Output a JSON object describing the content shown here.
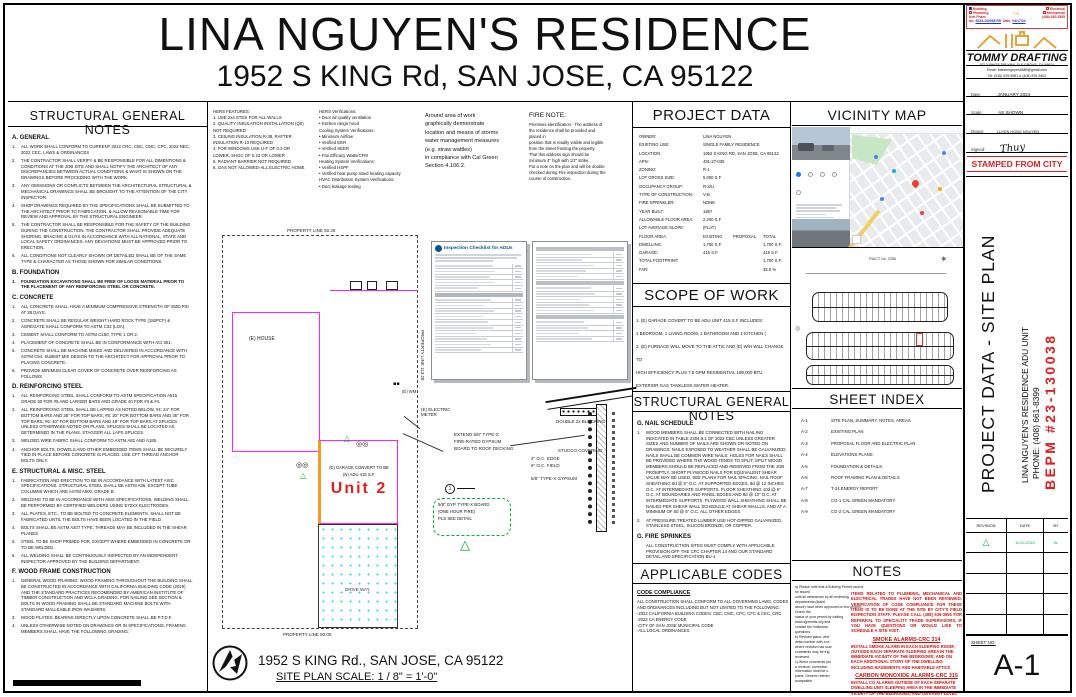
{
  "page": {
    "title": "LINA NGUYEN'S RESIDENCE",
    "subtitle": "1952 S KING Rd, SAN JOSE, CA 95122"
  },
  "structural_notes_left": {
    "title": "STRUCTURAL GENERAL NOTES",
    "sections": [
      {
        "heading": "A. GENERAL",
        "items": [
          {
            "num": "1.",
            "text": "ALL WORK SHALL CONFORM TO CURRENT 2022 CRC, CBC, CMC, CPC, 2022 NEC, 2022 CEC, LAWS & ORDINANCES"
          },
          {
            "num": "2.",
            "text": "THE CONTRACTOR SHALL VERIFY & BE RESPONSIBLE FOR ALL DIMENTIONS & CONDITIONS AT THE JOB SITE AND SHALL NOTIFY THE ARCHITECT OF ANY DISCREPANCIES BETWEEN ACTUAL CONDITIONS & WHAT IS SHOWN ON THE DRAWINGS BEFORE PROCEDING WITH THE WORK."
          },
          {
            "num": "3.",
            "text": "ANY OMISSIONS OR CONFLICTS BETWEEN THE ARCHITECTURAL STRUCTURAL & MECHANICAL DRAWINGS SHALL BE BROUGHT TO THE ATTENTION OF THE CITY INSPECTOR."
          },
          {
            "num": "4.",
            "text": "SHOP DRAWINGS REQUIRED BY THE SPECIFICATIONS SHALL BE SUBMITTED TO THE ARCHITECT PRIOR TO FABRICATION, & ALLOW REASONABLE TIME FOR REVIEW AND APPROVAL BY THE STRUCTURAL ENGINEER."
          },
          {
            "num": "5.",
            "text": "THE CONTRACTOR SHALL BE RESPONSIBLE FOR THE SAFETY OF THE BUILDING DURING THE CONSTRUCTION. THE CONTRACTOR SHALL PROVIDE ADEQUATE SHORING, BRACING & GUYS IN ACCORDANCE WITH ALL NATIONAL, STATE AND LOCAL SAFETY ORDINANCES. ANY DEVIATIONS MUST BE APPROVED PRIOR TO ERECTION."
          },
          {
            "num": "6.",
            "text": "ALL CONDITIONS NOT CLEARLY SHOWN OR DETAILED SHALL BE OF THE SAME TYPE & CHARACTER AS THOSE SHOWN FOR SIMILAR CONDITIONS."
          }
        ]
      },
      {
        "heading": "B. FOUNDATION",
        "items": [
          {
            "num": "1.",
            "text": "FOUNDATION EXCAVATIONS SHALL BE FREE OF LOOSE MATERIAL PRIOR TO THE PLACEMENT OF ANY REINFORCING STEEL OR CONCRETE.",
            "bold": true
          }
        ]
      },
      {
        "heading": "C. CONCRETE",
        "items": [
          {
            "num": "1.",
            "text": "ALL CONCRETE SHALL HAVE A MINIMUM COMPRESSIVE STRENGTH OF 2500 PSI AT 28 DAYS."
          },
          {
            "num": "2.",
            "text": "CONCRETE SHALL BE REGULAR WEIGHT HARD ROCK TYPE (150PCF) & AGREGATE SHALL CONFORM TO ASTM C33 (LOA)."
          },
          {
            "num": "3.",
            "text": "CEMENT SHALL CONFORM TO ASTM C150, TYPE 1 OR 2."
          },
          {
            "num": "4.",
            "text": "PLACEMENT OF CONCRETE SHALL BE IN CONFORMANCE WITH ACI 301."
          },
          {
            "num": "5.",
            "text": "CONCRETE SHALL BE MACHINE MIXED AND DELIVERED IN ACCORDANCE WITH ASTM C94. SUBMIT MIX DESIGN TO THE ARCHITECT FOR APPROVAL PRIOR TO PLACING CONCRETE."
          },
          {
            "num": "6.",
            "text": "PROVIDE MINIMUM CLEAR COVER OF CONCRETE OVER REINFORCING AS FOLLOWS"
          }
        ]
      },
      {
        "heading": "D. REINFORCING STEEL",
        "items": [
          {
            "num": "1.",
            "text": "ALL REINFORCING STEEL SHALL CONFORM TO ASTM SPECIFICATION A615 GRADE 60 FOR #5 AND LARGER BARS AND GRADE 40 FOR #3 & #4."
          },
          {
            "num": "2.",
            "text": "ALL REINFORCING STEEL SHALL BE LAPPED AS NOTED BELOW, #4: 24\" FOR BOTTOM BARS AND 35\" FOR TOP BARS; #5: 30\" FOR BOTTOM BARS AND 35\" FOR TOP BARS; #6: 40\" FOR BOTTOM BARS AND 48\" FOR TOP BARS AT SPLICES UNLESS OTHERWISE NOTED ON PLANS. SPLICES SHALL BE LOCATED AS DETERMINED IN THE PLANS. STAGGER ALL LAPS SPLICES."
          },
          {
            "num": "3.",
            "text": "WELDED WIRE FABRIC SHALL CONFORM TO ASTM A82 AND A185."
          },
          {
            "num": "4.",
            "text": "ANCHOR BOLTS, DOWELS AND OTHER EMBEDDED ITEMS SHALL BE SECURELY TIED IN PLACE BEFORE CONCRETE IS PLACED. USE CFT THREAD ANCHOR BOLTS ONLY."
          }
        ]
      },
      {
        "heading": "E. STRUCTURAL & MISC. STEEL",
        "items": [
          {
            "num": "1.",
            "text": "FABRICATION AND ERECTION TO BE IN ACCORDANCE WITH LATEST AISC SPECIFICATIONS. STRUCTURAL STEEL SHALL BE ASTM A36, EXCEPT TUBE COLUMNS WHICH ARE ASTM A500, GRADE B."
          },
          {
            "num": "2.",
            "text": "WELDING TO BE IN ACCORDANCE WITH AWS SPECIFICATIONS. WELDING SHALL BE PERFORMED BY CERTIFIED WELDERS USING E70XX ELECTRODES."
          },
          {
            "num": "3.",
            "text": "ALL PLATES, ETC., TO BE BOLTED TO CONCRETE ELEMENTS, SHALL NOT BE FABRICATED UNTIL THE BOLTS HAVE BEEN LOCATED IN THE FIELD."
          },
          {
            "num": "4.",
            "text": "BOLTS SHALL BE ASTM A307 TYPE. THREADS MAY BE INCLUDED IN THE SHEAR PLANES"
          },
          {
            "num": "5.",
            "text": "STEEL TO BE SHOP PRIMED FOR, EXCEPT WHERE EMBEDDED IN CONCRETE OR TO BE WELDED."
          },
          {
            "num": "6.",
            "text": "ALL WELDING SHALL BE CONTINUOUSLY INSPECTED BY AN INDEPENDENT INSPECTOR APPROVED BY THE BUILDING DEPARTMENT."
          }
        ]
      },
      {
        "heading": "F. WOOD FRAME CONSTRUCTION",
        "items": [
          {
            "num": "1.",
            "text": "GENERAL WOOD FRAMING: WOOD FRAMING THROUGHOUT THE BUILDING SHALL BE CONSTRUCTED IN ACCORDANCE WITH CALIFORNIA BUILDING CODE (2019) AND THE STANDARD PRACTICES RECOMENDED BY AMERICAN INSTITUTE OF TIMBER CONSTRUCTION AND WCLA GRADING. FOR NAILING SEE SECTION & BOLTS IN WOOD FRAMING SHALL BE STANDARD MACHINE BOLTS WITH STANDARD MALLEABLE IRON WASHERS."
          },
          {
            "num": "3.",
            "text": "WOOD PLATES: BEARING DIRECTLY UPON CONCRETE SHALL BE P.T.D.F."
          },
          {
            "num": "4.",
            "text": "UNLESS OTHERWISE NOTED ON DRAWINGS OR IN SPECIFICATIONS, FRAMING MEMBERS SHALL HAVE THE FOLLOWING GRADING:"
          }
        ]
      }
    ]
  },
  "hers": {
    "features": "HERS FEATURES:\n1. USE 2x4 STDS FOR ALL WALLS\n2. QUALITY INSULATION INSTALLATION (QII)\nNOT REQUIRED\n3. CEILING INSULATION R-38, RAFTER\nINSULATION R-13 REQUIRED\n4. FOR WINDOWS USE U-F OF 0.3 OR\nLOWER, SHGC OF 0.23 OR LOWER\n5. RADIANT BARRIER NOT REQUIRED\n6. GAS NOT ALLOWED-ALL ELECTRIC HOME",
    "verifications": "HERS Verifications:\n• Door air quality ventilation\n• Kitchen range hood\nCooling System Verifications:\n• Minimum Airflow\n• Verified EER\n• Verified SEER\n• Fan Efficacy Watts/CFM\nHeating System Verifications:\n• Verified HSPF\n• Verified heat pump rated heating capacity\nHVAC Distribution System Verifications:\n• Duct leakage testing"
  },
  "cal_green_note": "Around area of work\ngraphically demonstrate\nlocation and means of storms\nwater management measures\n(e.g. straw wattles)\nin compliance with Cal Green\nSection 4.106.2.",
  "fire_note": {
    "title": "FIRE NOTE:",
    "body": "Premises identification - The address of\nthe residence shall be provided and\nplaced in\nposition that is readily visible and legible\nfrom the street fronting the property.\nThat this address sign should be\nminimum 4\" high with 1/2\" strike.\nPut a note on the plan and will be double\nchecked during Fire inspection during the\ncourse of construction."
  },
  "checklist_doc": {
    "title": "Inspection Checklist for ADUs"
  },
  "project_data": {
    "title": "PROJECT DATA",
    "rows": [
      {
        "l": "OWNER:",
        "v": "LINA NGUYEN"
      },
      {
        "l": "EXISTING USE:",
        "v": "SINGLE FAMILY RESIDENCE"
      },
      {
        "l": "LOCATION:",
        "v": "1952 S KING RD, SAN JOSE, CA 95122"
      },
      {
        "l": "APN:",
        "v": "491-27-035"
      },
      {
        "l": "ZONING:",
        "v": "R-1"
      },
      {
        "l": "LOT GROSS SIZE:",
        "v": "5,000 S.F"
      },
      {
        "l": "OCCUPANCY GROUP:",
        "v": "R-3/U"
      },
      {
        "l": "TYPE OF CONSTRUCTION:",
        "v": "V-B"
      },
      {
        "l": "FIRE SPRINKLER:",
        "v": "NONE"
      },
      {
        "l": "YEAR BUILT:",
        "v": "1957"
      },
      {
        "l": "ALLOWABLE FLOOR AREA:",
        "v": "2,200 S.F"
      },
      {
        "l": "LOT AVERAGE SLOPE:",
        "v": "(FLAT)"
      }
    ],
    "floor_header": {
      "l": "FLOOR AREA:",
      "c1": "EXISTING",
      "c2": "PROPOSAL",
      "c3": "TOTAL"
    },
    "floor_rows": [
      {
        "l": "DWELLING:",
        "c1": "1,700 S.F.",
        "c2": "",
        "c3": "1,700 S.F."
      },
      {
        "l": "GARAGE:",
        "c1": "415 S.F.",
        "c2": "",
        "c3": "415 S.F."
      },
      {
        "l": "TOTAL FOOTPRINT:",
        "c1": "",
        "c2": "",
        "c3": "1,700 S.F."
      },
      {
        "l": "FAR:",
        "c1": "",
        "c2": "",
        "c3": "35.0 %"
      }
    ]
  },
  "scope_of_work": {
    "title": "SCOPE OF WORK",
    "body": "1. (E) GARAGE COVERT TO BE ADU UNIT 415 S.F INCLUDES:\n1 BEDROOM, 1 LIVING ROOM, 1 BATHROOM AND 1 KITCHEN |\n2. (E) FURNACE WILL MOVE TO THE ATTIC AND (E) W/H WILL CHANGE TO\nHIGH EFFICIENCY PLUS 7.5 GPM RESIDENTIAL 199,000 BTU\nEXTERIOR GAS TANKLESS WATER HEATER."
  },
  "structural_notes_right": {
    "title": "STRUCTURAL GENERAL NOTES",
    "sections": [
      {
        "heading": "G. NAIL SCHEDULE",
        "items": [
          {
            "num": "1.",
            "text": "WOOD MEMBERS SHALL BE CONNECTED WITH NAILING INDICATED IN TABLE 2304.9.1 OF 2022 CBC UNLESS GREATER SIZES AND NUMBER OF NAILS ARE SHOWN OR NOTED ON DRAWINGS; NAILS EXPOSED TO WEATHER SHALL BE GALVANIZED; NAILS SHALL BE COMMON WIRE NAILS; HOLES FOR NAILS SHALL BE PROVIDED WHERE THE WOOD TENDS TO SPLIT; SPLIT WOOD MEMBERS SHOULD BE REPLACED AND REMOVED FROM THE JOB PROMPTLY. SHORT PLYWOOD NAILS FOR EQUIVALENT SHEAR VALUE MAY BE USED. SEE PLANS FOR NAIL SPACING. NAIL ROOF SHEATHING 8d @ 6\" O.C. AT SUPPORTED EDGES, 8d @ 12 INCHES O.C. AT INTERMEDIATE SUPPORTS. FLOOR SHEATHING 10d @ 6\" O.C. AT BOUNDARIES AND PANEL EDGES AND 8d @ 10\" O.C. AT INTERMEDIATE SUPPORTS. PLYWOOD WALL SHEATHING SHALL BE NAILED PER SHEAR WALL SCHEDULE AT SHEAR WALLLS, AND AT A MINIMUM OF 8d @ 6\" O.C. ALL OTHER EDGES."
          },
          {
            "num": "2.",
            "text": "AT PRESSURE TREATED LUMBER USE HOT-DIPPED GALVANIZED, STAINLESS STEEL, SILICON BRONZE, OR COPPER."
          }
        ]
      },
      {
        "heading": "G. FIRE SPRINKES",
        "items": [
          {
            "num": "",
            "text": "ALL CONSTRUCTION SITES MUST COMPLY WITH APPLICABLE PROVISION OFF THE CFC CHAPTER 14 AND OUR STANDARD DETAIL AND SPECIFICATION BU-1"
          }
        ]
      }
    ]
  },
  "applicable_codes": {
    "title": "APPLICABLE CODES",
    "subtitle": "CODE COMPLIANCE",
    "intro": "ALL CONSTRUCTION SHALL CONFORM TO ALL GOVERNING LAWS, CODES AND ORDINANCES INCLUDING BUT NOT LIMITED TO THE FOLLOWING:",
    "items": [
      "-2022 CALIFORNIA BUILDING CODES: CBC, CMC, CPC, CFC & CEC, CRC.",
      "-2022 CA ENERGY CODE",
      "-CITY OF SAN JOSE MUNICIPAL CODE",
      "-ALL LOCAL ORDINANCES"
    ]
  },
  "vicinity_map": {
    "title": "VICINITY MAP"
  },
  "plat_map": {
    "tract_label": "TRACT No. 2358"
  },
  "sheet_index": {
    "title": "SHEET INDEX",
    "rows": [
      {
        "num": "A-1",
        "name": "SITE PLAN, SUMMARY, NOTES, AREAS"
      },
      {
        "num": "A-2",
        "name": "EXISTING PLAN"
      },
      {
        "num": "A-3",
        "name": "PROPOSAL FLOOR AND ELECTRIC PLAN"
      },
      {
        "num": "A-4",
        "name": "ELEVATIONS PLANS"
      },
      {
        "num": "A-5",
        "name": "FOUNDATION & DETAILS"
      },
      {
        "num": "A-6",
        "name": "ROOF FRAMING PLAN & DETAILS"
      },
      {
        "num": "A-7",
        "name": "T-24 ENERGY REPORT"
      },
      {
        "num": "A-8",
        "name": "CG-1 CAL GREEN MANDATORY"
      },
      {
        "num": "A-9",
        "name": "CG-2 CAL GREEN MANDATORY"
      }
    ]
  },
  "notes_panel": {
    "title": "NOTES",
    "black_text": "a) Please note that a Building Permit cannot be issued\nuntil all clearances by all reviewing departments (listed\nabove) have been approved on the project. Check the\nstatus of your permit by visiting www.sjpermits.org and\ncontact the individual\nquestions.\nb) Revised plans, whe\ndelta number with a re\nwhere revision has scar\ncomments may be trig\nreviewed.\nc) When comments (on\na revision, correction\ninformation shall be u\nplans. Generic referen\nacceptable.",
    "red_block": "ITEMS RELATED TO PLUMBING, MECHANICAL AND ELECTRICAL TRADES HAVE NOT BEEN REVIEWED. VERIFICATION OF CODE COMPLIANCE FOR THESE ITEMS IS TO BE DONE AT THE SITE BY CITY'S FIELD INSPECTION STAFF. PLEASE CALL (408) 535-3555 FOR REFERRAL TO SPECIALITY TRADE SUPERVISORS, IF YOU HAVE QUESTIONS OR WOULD LIKE TO SCHEDULE A SITE VISIT.",
    "smoke_heading": "SMOKE ALARMS-CRC 314",
    "smoke_body": "INSTALL SMOKE ALARM IN EACH SLEEPING ROOM; OUTSIDE EACH SEPARATE SLEEPING AREA IN THE IMMEDIATE VICINITY OF THE BEDROOMS; AND ON EACH ADDITIONAL STORY OF THE DWELLING INCLUDING BASEMENTS AND HABITABLE ATTICS",
    "co_heading": "CARBON MONOXIDE ALARMS-CRC 315",
    "co_body": "INSTALL CO ALARMS OUTSIDE OF EACH SEPARATE DWELLING UNIT SLEEPING AREA IN THE IMMEDIATE VICINITY OF THE BEDROOMS, AND ON EVERY LEVEL OF THE DWELLING UNIT, INCLUDING BASEMENTS"
  },
  "site_plan": {
    "property_line_top": "PROPERTY LINE 50.28",
    "property_line_right": "PROPERTY LINE 113.28",
    "property_line_bottom": "PROPERTY LINE 50.00",
    "house_label": "(E) HOUSE",
    "wm_label": "(E) WM",
    "electric_meter_label": "(E) ELECTRIC\nMETER",
    "garage_label": "(E) GARAGE CONVERT TO BE\n(N) ADU 415 S.F.",
    "unit_label": "Unit 2",
    "driveway_label": "DRIVE WAY",
    "address": "1952 S KING Rd., SAN JOSE, CA 95122",
    "scale": "SITE  PLAN SCALE: 1 / 8\" = 1'-0\""
  },
  "wall_detail": {
    "extend_note": "EXTEND 5/8\" TYPE-X\nFIRE-RATED GYPSUM\nBOARD TO ROOF DECKING",
    "oc_note": "4\" O.C. EDGE\n6\" O.C. FIELD",
    "gypsum_note": "5/8\" TYPE-X GYPSUM",
    "blocking_note": "DOUBLE 2x BLOCKING",
    "stucco_note": "STUCCO COVERING",
    "cloud_note": "5/8\" GYP. TYPE-X BOARD\n(ONE HOUR FIRE)\nPLS SEE DETAIL",
    "detail_marker": "1"
  },
  "titleblock": {
    "stamp": {
      "check1": "Building",
      "check2": "Electrical",
      "check3": "Plumbing",
      "check4": "Mechanical",
      "name": "Kiet Pham",
      "phone": "(408) 535-3555",
      "no_label": "No.",
      "no_value": "2023-130038 RS",
      "date_label": "Date:",
      "date_value": "04/17/24"
    },
    "firm": {
      "name": "TOMMY DRAFTING",
      "address": "9713 WHITE FIR WAY, ELK GROVE, CA 95624",
      "email": "Email: thelamnguyen3689@gmail.com",
      "tel": "Tel: (916) 529-9981 & (408) 876-5402"
    },
    "date_label": "Date:",
    "date_value": "JANUARY 2024",
    "scale_label": "Scale:",
    "scale_value": "AS SHOWN",
    "drawn_label": "Drawn:",
    "drawn_value": "LUYEN HONG NGUYEN",
    "signed_label": "Signed:",
    "signed_value": "Thuy",
    "stamped": "STAMPED FROM CITY",
    "sheet_title": "PROJECT DATA - SITE PLAN",
    "project_name": "LINA NGUYEN'S RESIDENCE ADU UNIT",
    "phone": "PHONE: (408) 661-8399",
    "permit": "BEPM #23-130038",
    "rev_headers": {
      "c1": "REVISION",
      "c2": "DATE",
      "c3": "BY"
    },
    "rev_row": {
      "mark": "△",
      "date": "10-01-2024",
      "by": "HL"
    },
    "sheet_no_label": "SHEET NO.",
    "sheet_no": "A-1"
  },
  "colors": {
    "magenta": "#ff22ff",
    "red_accent": "#cf1010",
    "green_marker": "#00b52a",
    "orange_logo": "#e8a33d",
    "cyan_dots": "#18dcdc",
    "stamp_red": "#cc2222",
    "stamp_blue": "#2233bb"
  }
}
